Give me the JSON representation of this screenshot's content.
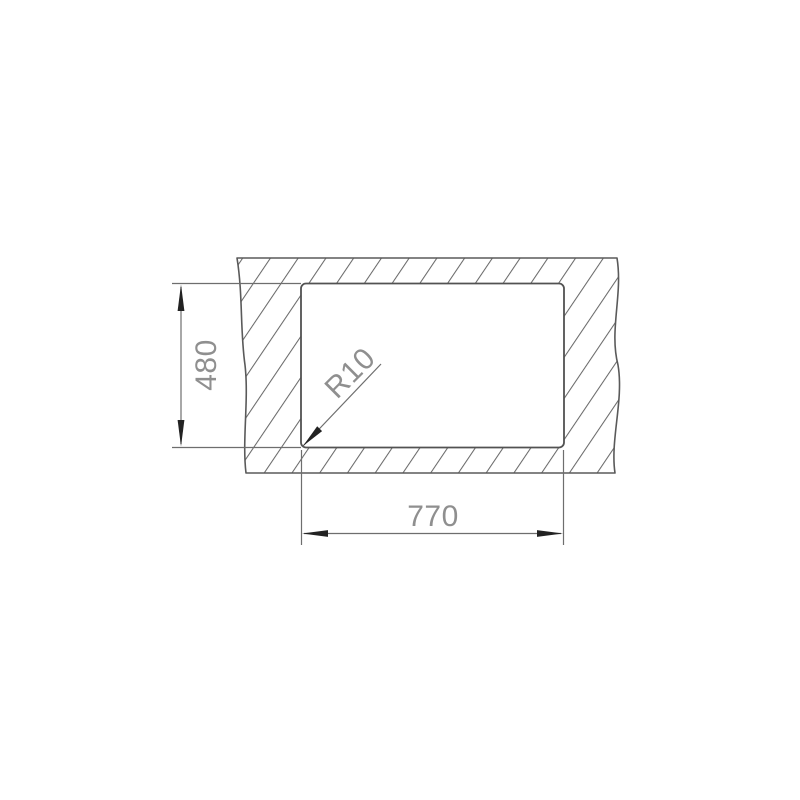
{
  "diagram": {
    "description": "Technical installation drawing of a rectangular countertop cutout with hatched panel section",
    "labels": {
      "height_mm": "480",
      "width_mm": "770",
      "corner_radius": "R10"
    },
    "colors": {
      "background": "#ffffff",
      "panel_outline": "#5a5a5a",
      "hatch_line": "#6a6a6a",
      "dimension_line": "#6e6e6e",
      "arrowhead": "#222222",
      "label_text": "#8f8f8f"
    }
  }
}
